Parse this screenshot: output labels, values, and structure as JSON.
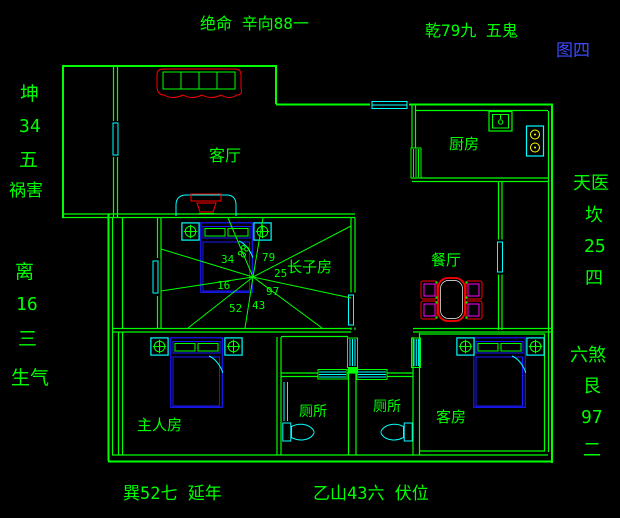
{
  "figure_label": "图四",
  "annotations": {
    "top_left": "绝命 辛向88一",
    "top_right": "乾79九 五鬼",
    "left_upper": [
      "坤",
      "34",
      "五",
      "祸害"
    ],
    "left_lower": [
      "离",
      "16",
      "三",
      "生气"
    ],
    "right_upper": [
      "天医",
      "坎",
      "25",
      "四"
    ],
    "right_lower": [
      "六煞",
      "艮",
      "97",
      "二"
    ],
    "bottom_left": "巽52七 延年",
    "bottom_right": "乙山43六 伏位"
  },
  "rooms": {
    "living_room": "客厅",
    "kitchen": "厨房",
    "eldest_son_room": "长子房",
    "dining_room": "餐厅",
    "master_bedroom": "主人房",
    "toilet_left": "厕所",
    "toilet_right": "厕所",
    "guest_room": "客房"
  },
  "compass": {
    "n88": "88",
    "n79": "79",
    "n25": "25",
    "n97": "97",
    "n43": "43",
    "n52": "52",
    "n16": "16",
    "n34": "34"
  },
  "colors": {
    "line_green": "#00ff00",
    "window_cyan": "#00ffff",
    "furniture_blue": "#1a1aff",
    "accent_red": "#ff0000",
    "chair_magenta": "#ff00ff",
    "burner_yellow": "#ffff00",
    "figure_label_blue": "#3b4bff",
    "background": "#000000"
  }
}
